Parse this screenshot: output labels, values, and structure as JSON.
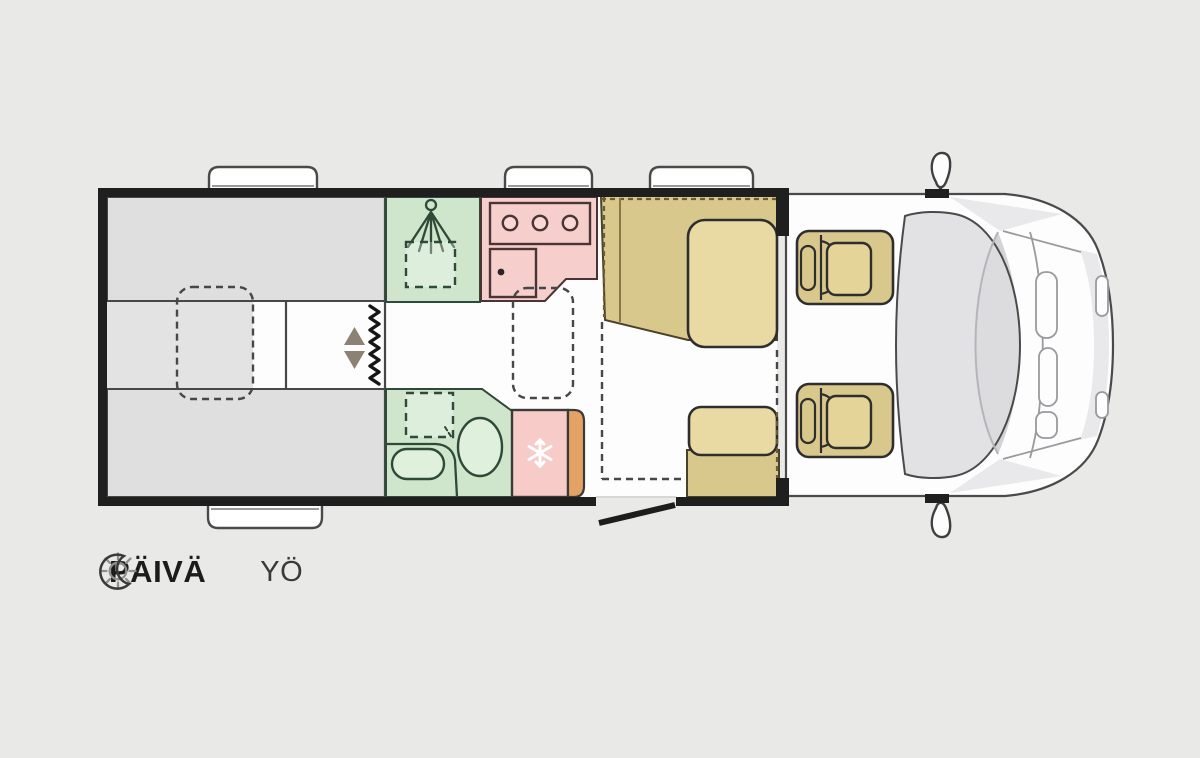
{
  "legend": {
    "day": {
      "icon": "sun-icon",
      "label": "PÄIVÄ"
    },
    "night": {
      "icon": "moon-icon",
      "label": "YÖ"
    }
  },
  "colors": {
    "bg": "#e9e9e8",
    "wall": "#1f1f1f",
    "floor": "#fdfdfd",
    "bed-gray": "#dfdfe0",
    "bed-strip": "#e3e3e4",
    "outline": "#474747",
    "wet-green": "#cfe6cd",
    "wet-line": "#2f4a38",
    "fixture": "#dff0dc",
    "kitchen-pink": "#f6cfcd",
    "kitchen-line": "#4a3434",
    "burner": "#f9d8d6",
    "fridge-pink": "#f7cbc8",
    "fridge-orange": "#e5a265",
    "seat-tan": "#d9c88c",
    "seat-line": "#4a4228",
    "seat-dash": "#6b5c33",
    "seat-seam": "#8a7748",
    "cushion-tan": "#e9daa4",
    "seatpad-tan": "#e4d498",
    "cab-line": "#4a4a4a",
    "glass": "#dddde1",
    "arrow-brown": "#8d8174",
    "text-dark": "#1c1c1a",
    "text-mid": "#3a3a38",
    "icon-gray": "#90908e"
  },
  "floorplan": {
    "type": "motorhome-floorplan-top-view",
    "features": [
      "rear-single-bed-top",
      "rear-single-bed-bottom",
      "bed-extension-dashed",
      "wardrobe-divider",
      "entrance-step-arrows",
      "concertina-partition-zigzag",
      "shower-cubicle",
      "shower-head-icon",
      "shower-tray-dashed",
      "kitchen-counter",
      "hob-3-burner",
      "kitchen-sink",
      "table-dashed",
      "washroom",
      "toilet",
      "washbasin",
      "fridge",
      "snowflake-icon",
      "dinette-bench",
      "side-bench",
      "drop-down-bed-dashed-outline",
      "cab-seat-rear-facing-top",
      "cab-seat-rear-facing-bottom",
      "entry-door",
      "wall-windows",
      "cab-front-body",
      "windshield",
      "side-mirror-top",
      "side-mirror-bottom"
    ]
  }
}
